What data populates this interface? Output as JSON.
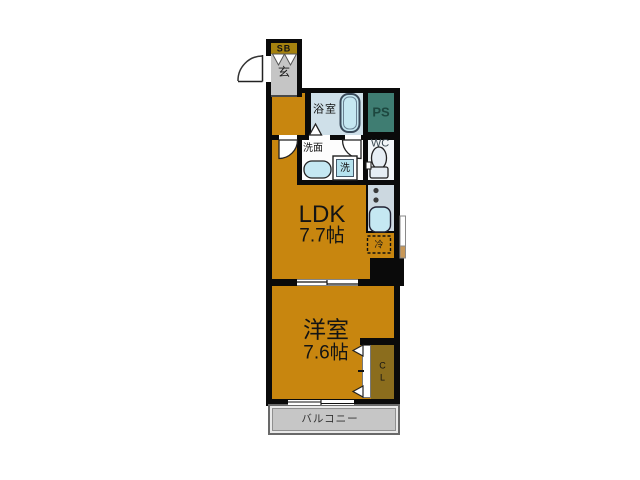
{
  "floor_plan": {
    "entrance": {
      "shoe_box": "SB",
      "genkan": "玄"
    },
    "bathroom": {
      "label": "浴室"
    },
    "pipe_space": {
      "label": "PS"
    },
    "washroom": {
      "label": "洗面",
      "washing_machine": "洗"
    },
    "toilet": {
      "label": "WC"
    },
    "kitchen": {
      "refrigerator": "冷"
    },
    "ldk": {
      "label": "LDK",
      "area": "7.7帖"
    },
    "western_room": {
      "label": "洋室",
      "area": "7.6帖"
    },
    "closet": {
      "line1": "C",
      "line2": "L"
    },
    "balcony": {
      "label": "バルコニー"
    },
    "fixtures": [
      "entry-door-arc",
      "shoe-box-door-triangles",
      "bathtub",
      "bath-door-triangle",
      "washroom-door-arc",
      "ldk-door-arc",
      "washbasin-sink",
      "washing-machine",
      "toilet-bowl",
      "stove-burners",
      "kitchen-sink",
      "refrigerator-dashed-box",
      "sliding-door",
      "sliding-window",
      "closet-folding-door-arrows",
      "side-window"
    ]
  },
  "colors": {
    "room_orange": "#c8860f",
    "closet_olive": "#8b6d1d",
    "shoe_box_gold": "#a5820f",
    "bathroom_blue": "#cfe0e9",
    "pipe_space_teal": "#3f7d72",
    "kitchen_gray_blue": "#ccd8e0",
    "fixture_blue": "#c5e8f2",
    "genkan_gray": "#c5c5c5",
    "balcony_gray": "#c6c6c6",
    "wall_black": "#0a0a0a"
  }
}
